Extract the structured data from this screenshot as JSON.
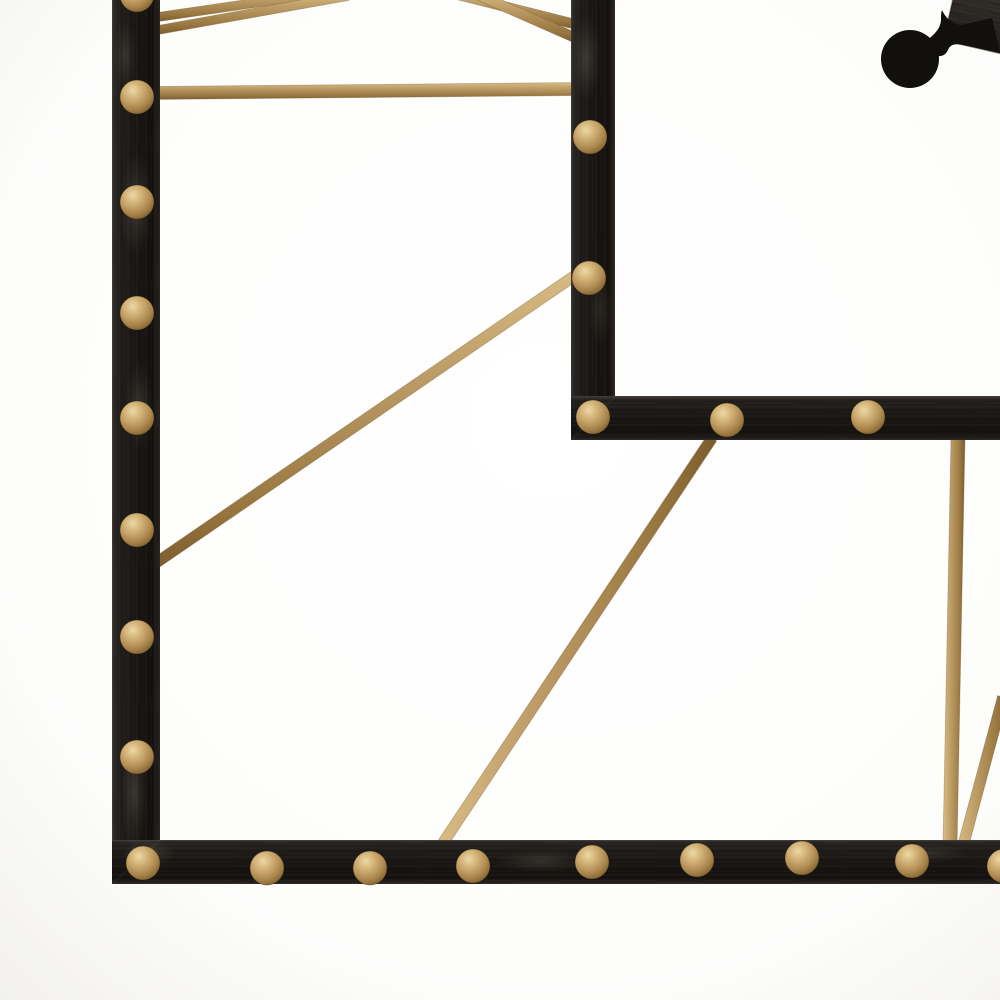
{
  "meta": {
    "title": "Black and gold metal wall clock — corner detail",
    "description": "Close-up of a black brushed-metal wall clock frame corner with round gold rivet studs, gold metal support rods, and a black clock hand with circular counterweight on a white background",
    "image_type": "product-photo"
  },
  "canvas": {
    "width": 1000,
    "height": 1000
  },
  "palette": {
    "background_center": "#ffffff",
    "background_edge": "#f2f1ee",
    "frame_black": "#191613",
    "frame_black_light": "#322e2a",
    "gold_mid": "#b5945e",
    "gold_light": "#d9bc85",
    "gold_dark": "#7c5c2e",
    "stud_highlight": "#ecd8a4",
    "hand_black": "#12100d",
    "hub_gray": "#39342f"
  },
  "frame": {
    "bars": [
      {
        "name": "outer-left-bar",
        "x": 112,
        "y": -10,
        "w": 48,
        "h": 894,
        "dir": "v"
      },
      {
        "name": "outer-bottom-bar",
        "x": 112,
        "y": 840,
        "w": 888,
        "h": 44,
        "dir": "h"
      },
      {
        "name": "inner-vertical-bar",
        "x": 571,
        "y": -10,
        "w": 44,
        "h": 450,
        "dir": "v"
      },
      {
        "name": "inner-horizontal-bar",
        "x": 571,
        "y": 396,
        "w": 429,
        "h": 44,
        "dir": "h"
      }
    ],
    "seams": [
      {
        "x1": 160,
        "y1": 840,
        "x2": 113,
        "y2": 883
      },
      {
        "x1": 615,
        "y1": 397,
        "x2": 572,
        "y2": 439
      }
    ],
    "rods": [
      {
        "name": "rod-top-left-upper",
        "x1": 158,
        "y1": 17,
        "x2": 330,
        "y2": -8,
        "w": 9
      },
      {
        "name": "rod-top-left-lower",
        "x1": 158,
        "y1": 30,
        "x2": 348,
        "y2": -4,
        "w": 9
      },
      {
        "name": "rod-top-mid-upper",
        "x1": 455,
        "y1": -6,
        "x2": 578,
        "y2": 25,
        "w": 10
      },
      {
        "name": "rod-top-mid-lower",
        "x1": 476,
        "y1": -6,
        "x2": 578,
        "y2": 39,
        "w": 10
      },
      {
        "name": "rod-horizontal",
        "x1": 150,
        "y1": 93,
        "x2": 580,
        "y2": 89,
        "w": 13
      },
      {
        "name": "rod-diagonal-left",
        "x1": 150,
        "y1": 567,
        "x2": 580,
        "y2": 272,
        "w": 11
      },
      {
        "name": "rod-diagonal-middle",
        "x1": 712,
        "y1": 438,
        "x2": 441,
        "y2": 846,
        "w": 11
      },
      {
        "name": "rod-vertical-right",
        "x1": 958,
        "y1": 438,
        "x2": 950,
        "y2": 846,
        "w": 14
      },
      {
        "name": "rod-diagonal-right",
        "x1": 963,
        "y1": 846,
        "x2": 1003,
        "y2": 697,
        "w": 11
      }
    ],
    "studs": {
      "radius": 17,
      "positions": [
        [
          137,
          -5
        ],
        [
          137,
          97
        ],
        [
          137,
          202
        ],
        [
          137,
          313
        ],
        [
          137,
          418
        ],
        [
          137,
          530
        ],
        [
          137,
          637
        ],
        [
          137,
          757
        ],
        [
          143,
          863
        ],
        [
          267,
          868
        ],
        [
          370,
          868
        ],
        [
          473,
          866
        ],
        [
          592,
          862
        ],
        [
          697,
          860
        ],
        [
          802,
          858
        ],
        [
          912,
          861
        ],
        [
          1004,
          866
        ],
        [
          590,
          137
        ],
        [
          589,
          278
        ],
        [
          593,
          417
        ],
        [
          727,
          420
        ],
        [
          868,
          417
        ]
      ]
    },
    "wear_marks": [
      {
        "cx": 136,
        "cy": 205,
        "rx": 16,
        "ry": 52,
        "o": 0.33
      },
      {
        "cx": 139,
        "cy": 405,
        "rx": 14,
        "ry": 44,
        "o": 0.3
      },
      {
        "cx": 134,
        "cy": 792,
        "rx": 13,
        "ry": 56,
        "o": 0.32
      },
      {
        "cx": 149,
        "cy": 853,
        "rx": 27,
        "ry": 14,
        "o": 0.3
      },
      {
        "cx": 586,
        "cy": 58,
        "rx": 15,
        "ry": 42,
        "o": 0.33
      },
      {
        "cx": 600,
        "cy": 310,
        "rx": 12,
        "ry": 36,
        "o": 0.2
      },
      {
        "cx": 540,
        "cy": 861,
        "rx": 44,
        "ry": 12,
        "o": 0.28
      },
      {
        "cx": 928,
        "cy": 853,
        "rx": 40,
        "ry": 10,
        "o": 0.22
      },
      {
        "cx": 125,
        "cy": 55,
        "rx": 12,
        "ry": 34,
        "o": 0.25
      }
    ]
  },
  "clock_hand": {
    "counterweight_circle": {
      "cx": 910,
      "cy": 59,
      "r": 29
    },
    "spade_path": "M 923 43 C 932 37 938 31 940 25 C 942 20 940 15 942 10 C 946 19 953 24 961 25 L 992 18 L 1000 52 L 963 45 C 954 43 950 45 948 50 C 945 57 937 58 933 53 C 930 49 926 46 923 43 Z",
    "hub_plate": {
      "x": 954,
      "y": -70,
      "w": 140,
      "h": 122,
      "rotate": 13,
      "rx": 1000,
      "ry": 0
    }
  }
}
